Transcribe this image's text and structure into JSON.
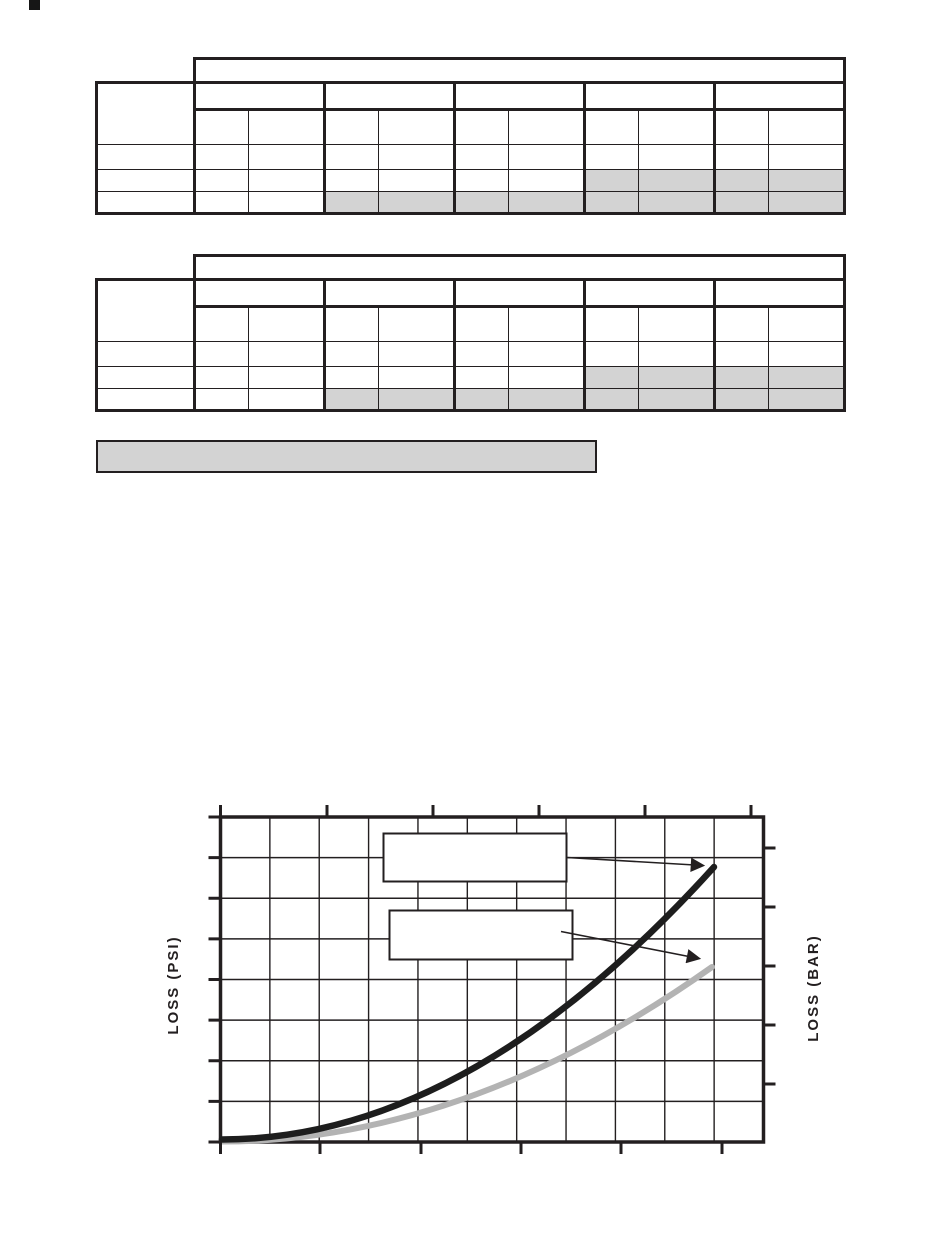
{
  "page": {
    "background": "#ffffff"
  },
  "colors": {
    "line": "#231f20",
    "shaded_cell": "#d3d3d3",
    "note_bar_fill": "#d3d3d3",
    "curve_black": "#1d1d1d",
    "curve_gray": "#b3b3b3",
    "callout_fill": "#ffffff"
  },
  "tables": [
    {
      "name": "upper spec table",
      "text_content": "",
      "column_groups": 5,
      "sub_columns_per_group": 2,
      "data_rows": 3,
      "shading": "last data row shaded in groups 2-5; middle data row shaded in groups 4-5"
    },
    {
      "name": "lower spec table",
      "text_content": "",
      "column_groups": 5,
      "sub_columns_per_group": 2,
      "data_rows": 3,
      "shading": "last data row shaded in groups 2-5; middle data row shaded in groups 4-5"
    }
  ],
  "note_bar": {
    "text": ""
  },
  "chart": {
    "ylabel_left": "LOSS (PSI)",
    "ylabel_right": "LOSS (BAR)"
  },
  "chart_data": {
    "type": "line",
    "title": "",
    "xlabel": "",
    "ylabel_left": "LOSS (PSI)",
    "ylabel_right": "LOSS (BAR)",
    "tick_labels": [],
    "grid": {
      "columns": 11,
      "rows": 8,
      "grid_on": true
    },
    "axes": {
      "left_ticks": 9,
      "right_ticks": 5,
      "top_ticks": 6,
      "bottom_ticks": 6,
      "numeric_labels_visible": false
    },
    "series": [
      {
        "name": "upper curve (black)",
        "color": "#1d1d1d",
        "shape": "quadratic rise from origin",
        "start_frac": {
          "x": 0.0,
          "y": 0.0
        },
        "end_frac": {
          "x": 0.91,
          "y": 0.846
        }
      },
      {
        "name": "lower curve (gray)",
        "color": "#b3b3b3",
        "shape": "quadratic rise from origin",
        "start_frac": {
          "x": 0.0,
          "y": 0.0
        },
        "end_frac": {
          "x": 0.906,
          "y": 0.538
        }
      }
    ],
    "callout_boxes": [
      {
        "label": "",
        "points_to": "upper curve (black)"
      },
      {
        "label": "",
        "points_to": "lower curve (gray)"
      }
    ],
    "legend_position": "two empty callout boxes inside plot with arrows to curves"
  }
}
